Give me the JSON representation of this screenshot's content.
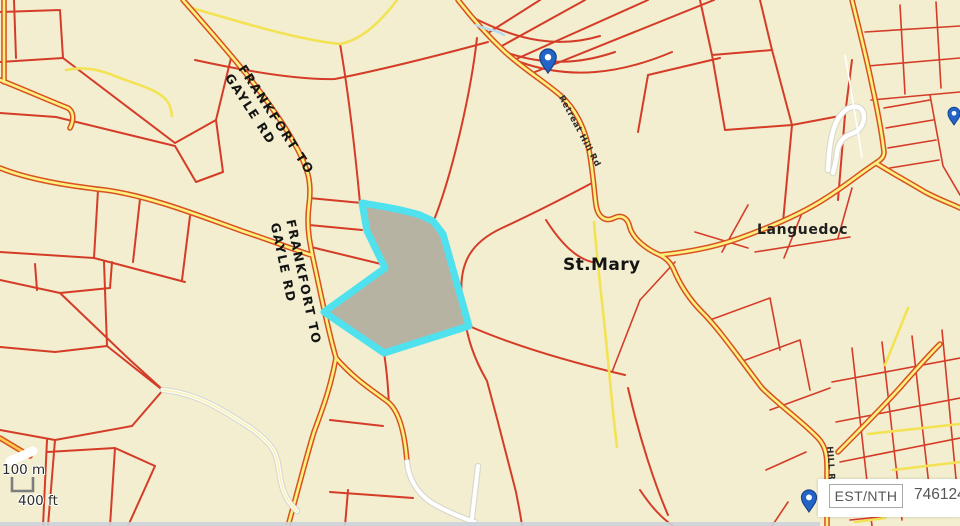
{
  "map": {
    "colors": {
      "bg": "#f2eecf",
      "parcel": "#d53c28",
      "road-case": "#d8511f",
      "road-fill": "#fdf182",
      "minor-road": "#f3e354",
      "white-road": "#ffffff",
      "white-road-case": "#d9d9cc",
      "highlight-stroke": "#4fe2ee",
      "highlight-fill": "#b6b3a2",
      "pin": "#2264c8",
      "pin-dark": "#173f8a",
      "stream": "#b9d9ee",
      "label": "#141414",
      "bottom-strip": "#ccd1da"
    },
    "labels": {
      "road1_line1": "FRANKFORT TO",
      "road1_line2": "GAYLE RD",
      "road2_line1": "FRANKFORT TO",
      "road2_line2": "GAYLE RD",
      "place1": "St.Mary",
      "place2": "Languedoc",
      "road3": "Retreat Hill Rd",
      "road4": "HILL RD"
    }
  },
  "scale_bar": {
    "metric": "100 m",
    "imperial": "400 ft"
  },
  "coordinate_panel": {
    "button": "EST/NTH",
    "value": "746124.2"
  }
}
